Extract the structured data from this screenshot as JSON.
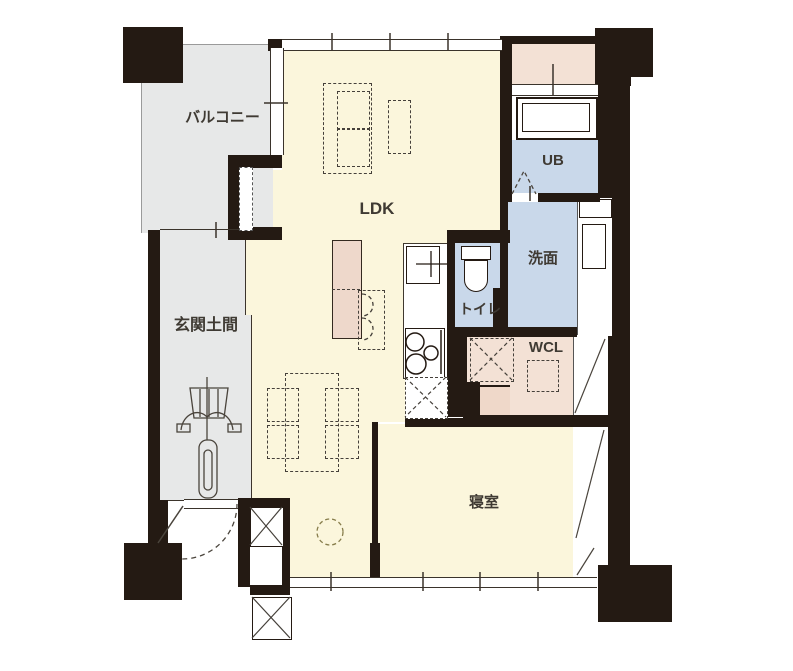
{
  "plan": {
    "title": "apartment-floor-plan",
    "rooms": {
      "balcony": {
        "label": "バルコニー"
      },
      "entrance": {
        "label": "玄関土間"
      },
      "ldk": {
        "label": "LDK"
      },
      "unit_bath": {
        "label": "UB"
      },
      "washroom": {
        "label": "洗面"
      },
      "toilet": {
        "label": "トイレ"
      },
      "closet": {
        "label": "WCL"
      },
      "bedroom": {
        "label": "寝室"
      }
    },
    "fixtures": [
      "bathtub",
      "toilet-bowl",
      "kitchen-sink",
      "gas-stove",
      "kitchen-counter",
      "washing-machine-space",
      "refrigerator-space",
      "dining-table",
      "chairs",
      "sofa",
      "bicycle",
      "entrance-door-swing",
      "folding-door",
      "pocket-sliding-door",
      "structural-pillar",
      "storage-cross-box"
    ],
    "colors": {
      "wall": "#241a13",
      "floor_cream": "#fbf6dc",
      "wet_area_blue": "#c9d8ea",
      "terrace_pink": "#f3e1d5",
      "outdoor_gray": "#e7e8e8",
      "counter_pink": "#eed8cb",
      "background": "#ffffff"
    }
  }
}
